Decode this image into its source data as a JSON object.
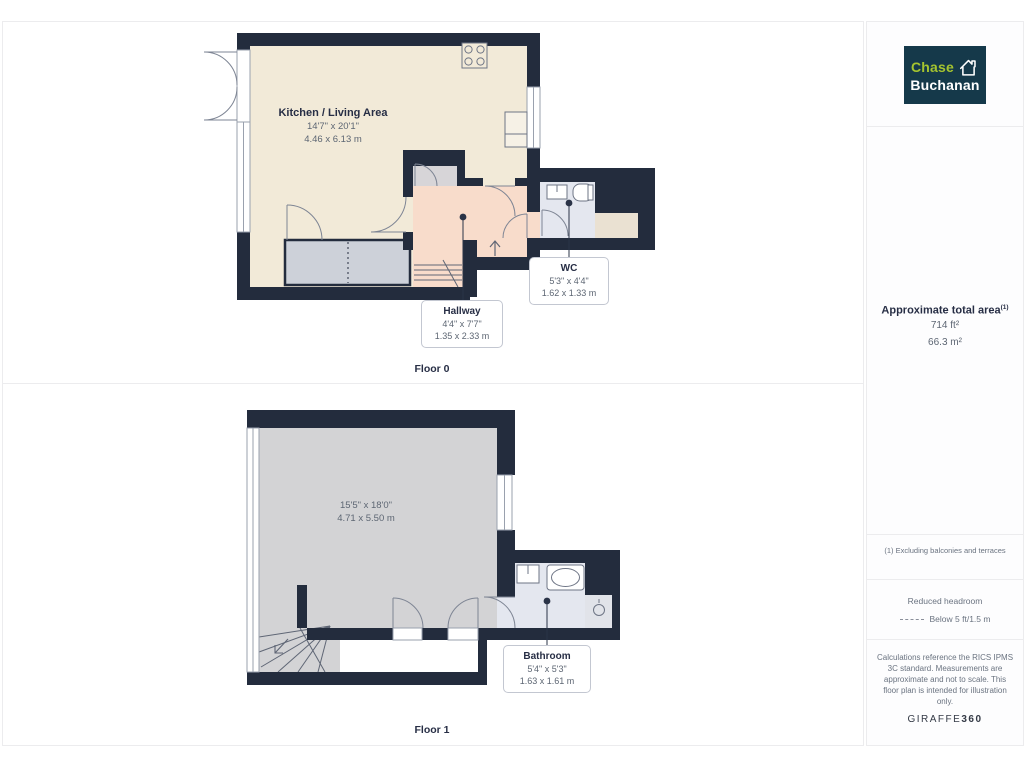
{
  "floorplan": {
    "floor0": {
      "caption": "Floor 0",
      "rooms": {
        "kitchen": {
          "name": "Kitchen / Living Area",
          "imperial": "14'7\" x 20'1\"",
          "metric": "4.46 x 6.13 m"
        },
        "hallway": {
          "name": "Hallway",
          "imperial": "4'4\" x 7'7\"",
          "metric": "1.35 x 2.33 m"
        },
        "wc": {
          "name": "WC",
          "imperial": "5'3\" x 4'4\"",
          "metric": "1.62 x 1.33 m"
        }
      }
    },
    "floor1": {
      "caption": "Floor 1",
      "rooms": {
        "main": {
          "imperial": "15'5\" x 18'0\"",
          "metric": "4.71 x 5.50 m"
        },
        "bathroom": {
          "name": "Bathroom",
          "imperial": "5'4\" x 5'3\"",
          "metric": "1.63 x 1.61 m"
        }
      }
    }
  },
  "sidebar": {
    "logo": {
      "line1": "Chase",
      "line2": "Buchanan"
    },
    "area": {
      "title": "Approximate total area",
      "footnote_marker": "(1)",
      "imperial": "714 ft²",
      "metric": "66.3 m²"
    },
    "footnote": "(1) Excluding balconies and terraces",
    "headroom": {
      "title": "Reduced headroom",
      "legend": "Below 5 ft/1.5 m"
    },
    "disclaimer": "Calculations reference the RICS IPMS 3C standard. Measurements are approximate and not to scale. This floor plan is intended for illustration only.",
    "brand": {
      "name": "GIRAFFE",
      "suffix": "360"
    }
  },
  "colors": {
    "wall": "#232c3d",
    "kitchen_fill": "#f2ead8",
    "hallway_fill": "#f8dccb",
    "bathroom_fill": "#e4e7ef",
    "floor1_room_fill": "#d3d3d5",
    "logo_navy": "#15394a",
    "logo_green": "#a5c42f",
    "text_navy": "#272e45",
    "text_gray": "#5d6673"
  }
}
